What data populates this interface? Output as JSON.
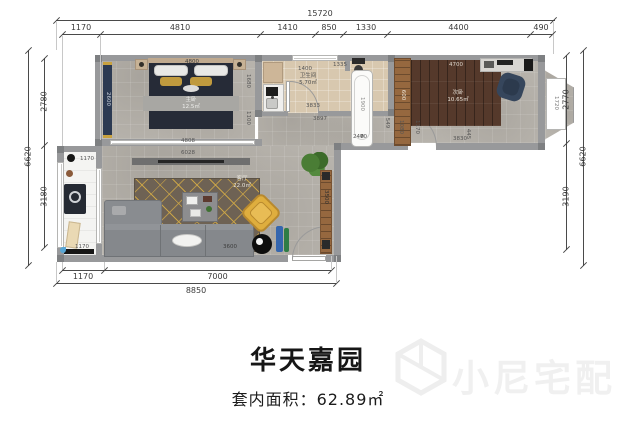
{
  "plan": {
    "title": "华天嘉园",
    "area_label": "套内面积：62.89㎡",
    "watermark": "小尼宅配"
  },
  "dims": {
    "top_total": "15720",
    "top": [
      "1170",
      "4810",
      "1410",
      "850",
      "1330",
      "4400",
      "490"
    ],
    "left_total": "6620",
    "left": [
      "2780",
      "3180"
    ],
    "right_total": "6620",
    "right": [
      "2770",
      "3190"
    ],
    "bottom": [
      "1170",
      "7000"
    ],
    "bottom_total": "8850"
  },
  "rooms": {
    "bedroom1": {
      "name": "主卧",
      "area": "12.5㎡"
    },
    "bathroom": {
      "name": "卫生间",
      "area": "5.70㎡"
    },
    "bedroom2": {
      "name": "次卧",
      "area": "10.65㎡"
    },
    "living": {
      "name": "客厅",
      "area": "22.0㎡"
    }
  },
  "inner": {
    "bed_top": "4800",
    "bed_window": "4808",
    "wardrobe": "2600",
    "b1_a": "1680",
    "b1_b": "1100",
    "k_top": "1400",
    "bath_w": "3833",
    "toilet": "1335",
    "tub": "1900",
    "ward2": "600",
    "wood_top": "4700",
    "b2_floor": "3830",
    "b2_side": "445",
    "bay": "1720",
    "door_a": "1080",
    "door_b": "1170",
    "cor_a": "3897",
    "cor_b": "2470",
    "cor_c": "549",
    "tv": "6028",
    "sofa": "3600",
    "cabinet": "3500",
    "bal_top": "1170",
    "bal_bottom": "1170"
  }
}
